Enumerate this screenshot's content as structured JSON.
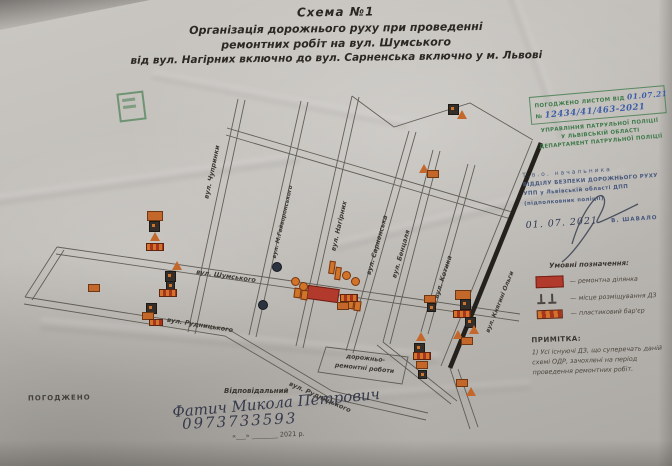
{
  "title": {
    "line1": "Схема №1",
    "line2": "Організація дорожнього руху при проведенні",
    "line3": "ремонтних робіт на вул. Шумського",
    "line4": "від вул. Нагірних включно до вул. Сарненська включно у м. Львові"
  },
  "approval_stamp": {
    "agreed_prefix": "ПОГОДЖЕНО ЛИСТОМ ВІД",
    "date_handwritten": "01.07.21",
    "number_prefix": "№",
    "number_handwritten": "12434/41/463-2021",
    "org_line1": "УПРАВЛІННЯ ПАТРУЛЬНОЇ ПОЛІЦІЇ",
    "org_line2": "У ЛЬВІВСЬКІЙ ОБЛАСТІ",
    "org_line3": "ДЕПАРТАМЕНТ ПАТРУЛЬНОЇ ПОЛІЦІЇ"
  },
  "police_block": {
    "line1": "Т.в.о. начальника",
    "line2": "ВІДДІЛУ БЕЗПЕКИ ДОРОЖНЬОГО РУХУ",
    "line3": "УПП у Львівській області ДПП",
    "line4": "(підполковник поліції)",
    "date_handwritten": "01. 07. 2021",
    "name": "В. ШАВАЛО"
  },
  "legend": {
    "title": "Умовні позначення:",
    "items": [
      {
        "symbol": "repair-area-swatch",
        "label": "—  ремонтна ділянка"
      },
      {
        "symbol": "sign-posts",
        "label": "—  місце розміщування ДЗ"
      },
      {
        "symbol": "plastic-barrier-swatch",
        "label": "—  пластиковий бар'єр"
      }
    ]
  },
  "note": {
    "title": "ПРИМІТКА:",
    "text": "1) Усі існуючі ДЗ, що суперечать даній схемі ОДР, зачохлені на період проведення ремонтних робіт."
  },
  "map": {
    "streets": {
      "chuprynky": "вул. Чупринки",
      "haivoronskoho": "вул. М.Гайворонського",
      "nahirnykh": "вул. Нагірних",
      "sarnenska": "вул. Сарненська",
      "bentsalya": "вул. Бенцаля",
      "kotyka": "вул. Котика",
      "kniahyni_olhy": "вул. Княгині Ольги",
      "shumskoho": "вул. Шумського",
      "rudnytskoho": "вул. Рудницького"
    },
    "work_zone_label": "дорожньо-ремонтні роботи"
  },
  "footer": {
    "agreed": "ПОГОДЖЕНО",
    "responsible_label": "Відповідальний",
    "responsible_name": "Фатич Микола Петрович",
    "phone": "0973733593",
    "date_blank": "«___» ________ 2021 р."
  },
  "colors": {
    "stamp_green": "#3e7a4a",
    "stamp_blue": "#46587e",
    "repair_red": "#b23a2c",
    "sign_orange": "#c4672a"
  }
}
